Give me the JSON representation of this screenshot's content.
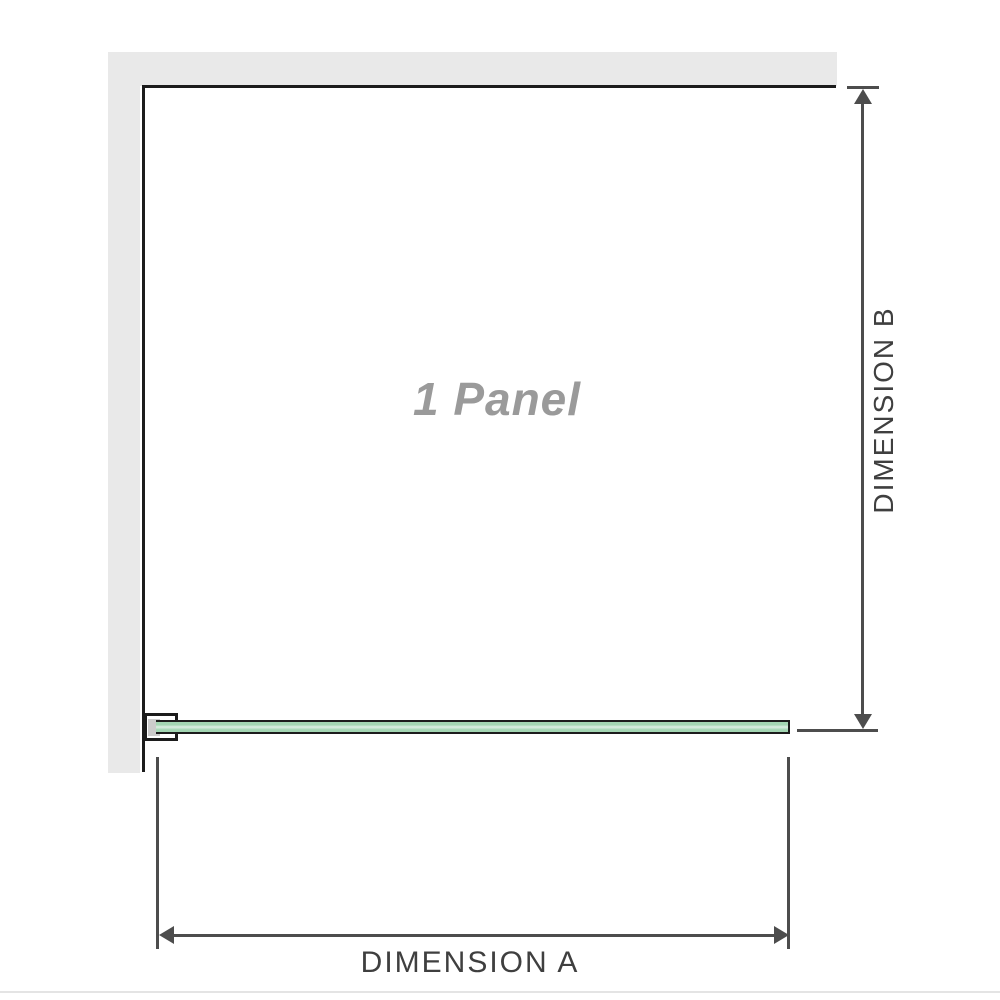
{
  "diagram": {
    "panel_label": "1 Panel",
    "dimension_a": {
      "label": "DIMENSION A"
    },
    "dimension_b": {
      "label": "DIMENSION B"
    }
  },
  "colors": {
    "wall_gray": "#e9e9e9",
    "frame_black": "#1c1c1c",
    "dim_line": "#4d4d4d",
    "text_dark": "#3f3f3f",
    "label_gray": "#9a9a9a",
    "glass_green": "#a3d6b3",
    "glass_green_light": "#ddefe4",
    "bracket_pad": "#cccccc",
    "photo_edge": "#e4e4e4"
  }
}
